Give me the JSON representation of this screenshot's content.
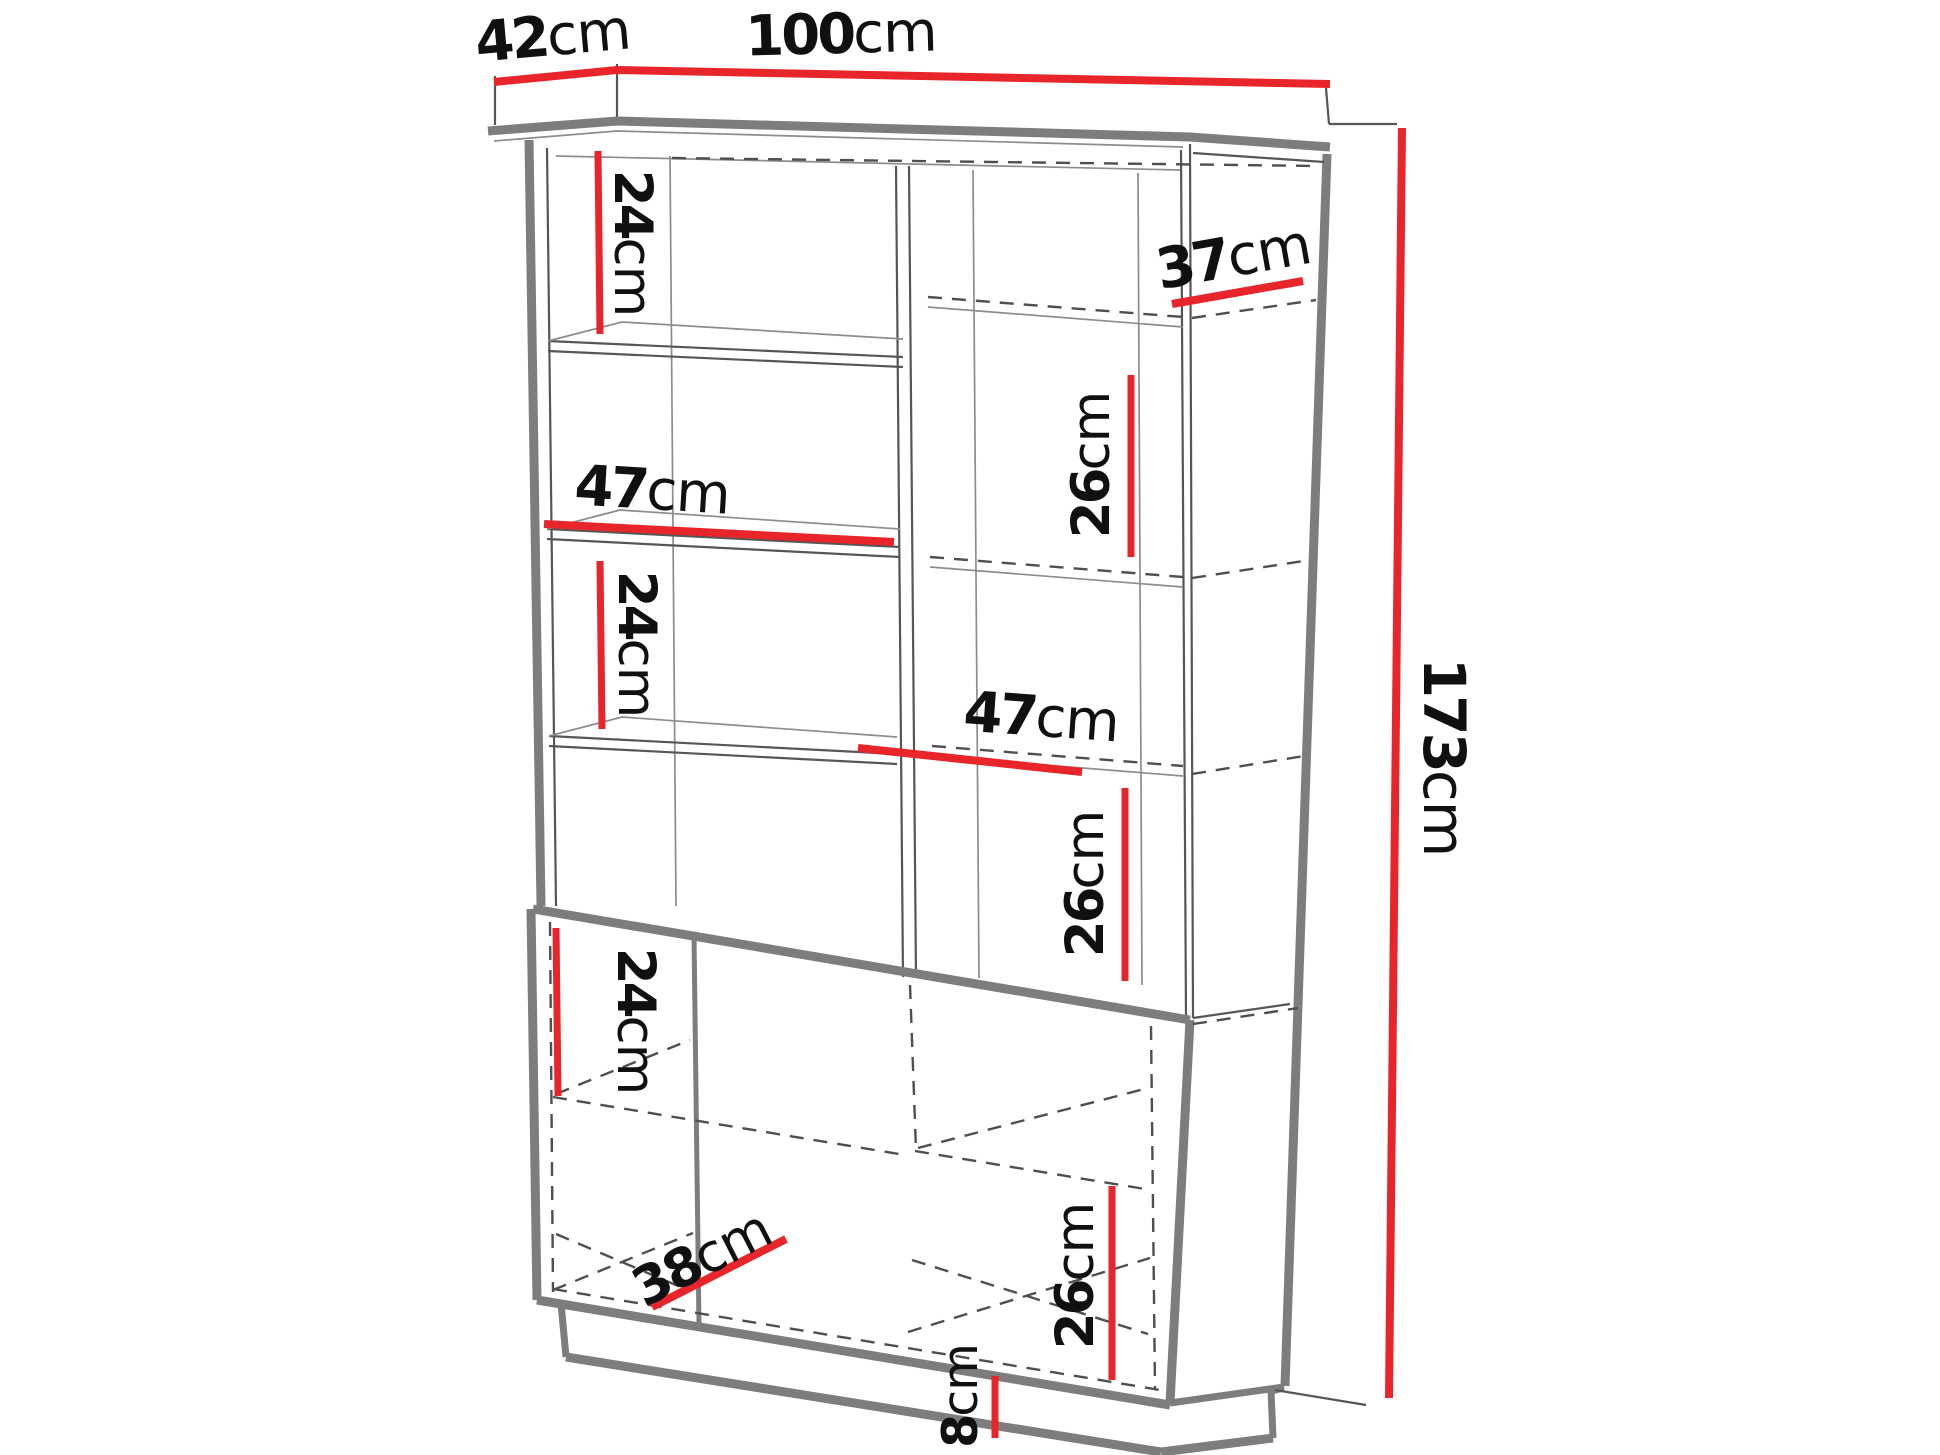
{
  "page": {
    "title": "Cabinet dimensions diagram",
    "background": "#ffffff"
  },
  "colors": {
    "dimension": "#e8252a",
    "outline_thick": "#7d7d7d",
    "outline_thin": "#565656",
    "hidden_dashed": "#4f4f4f",
    "text": "#101010"
  },
  "diagram": {
    "type": "furniture-dimension-diagram",
    "overall": {
      "width_cm": 100,
      "depth_cm": 42,
      "height_cm": 173,
      "plinth_cm": 8
    },
    "labels": [
      {
        "id": "top-depth",
        "value": "42",
        "unit": "cm"
      },
      {
        "id": "top-width",
        "value": "100",
        "unit": "cm"
      },
      {
        "id": "upper-left-shelf-height",
        "value": "24",
        "unit": "cm"
      },
      {
        "id": "left-shelf-width",
        "value": "47",
        "unit": "cm"
      },
      {
        "id": "mid-left-shelf-height",
        "value": "24",
        "unit": "cm"
      },
      {
        "id": "side-shelf-depth",
        "value": "37",
        "unit": "cm"
      },
      {
        "id": "upper-right-shelf-height",
        "value": "26",
        "unit": "cm"
      },
      {
        "id": "right-shelf-width",
        "value": "47",
        "unit": "cm"
      },
      {
        "id": "mid-right-shelf-height",
        "value": "26",
        "unit": "cm"
      },
      {
        "id": "lower-left-shelf-height",
        "value": "24",
        "unit": "cm"
      },
      {
        "id": "lower-shelf-depth",
        "value": "38",
        "unit": "cm"
      },
      {
        "id": "lower-right-shelf-height",
        "value": "26",
        "unit": "cm"
      },
      {
        "id": "plinth-height",
        "value": "8",
        "unit": "cm"
      },
      {
        "id": "total-height",
        "value": "173",
        "unit": "cm"
      }
    ]
  }
}
